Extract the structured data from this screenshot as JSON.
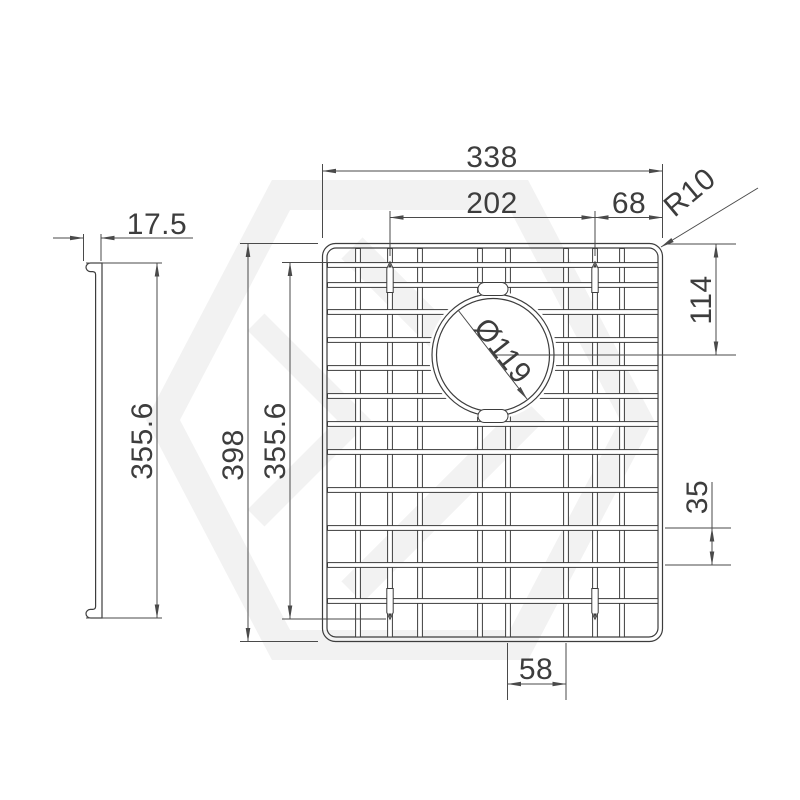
{
  "drawing": {
    "type": "sink-grid-technical-drawing",
    "views": {
      "side_view": {
        "depth": "17.5",
        "height": "355.6"
      },
      "plan_view": {
        "overall_width": "338",
        "pin_spacing_width": "202",
        "pin_edge_offset": "68",
        "corner_radius": "R10",
        "hole_center_from_top": "114",
        "hole_diameter": "Ø119",
        "overall_height": "398",
        "pin_spacing_height": "355.6",
        "wire_gap": "35",
        "bottom_wire_spacing": "58"
      }
    },
    "colors": {
      "background": "#ffffff",
      "object_line": "#3d3d3d",
      "dimension_line": "#4a4a4a",
      "watermark": "#f2f2f2"
    }
  }
}
